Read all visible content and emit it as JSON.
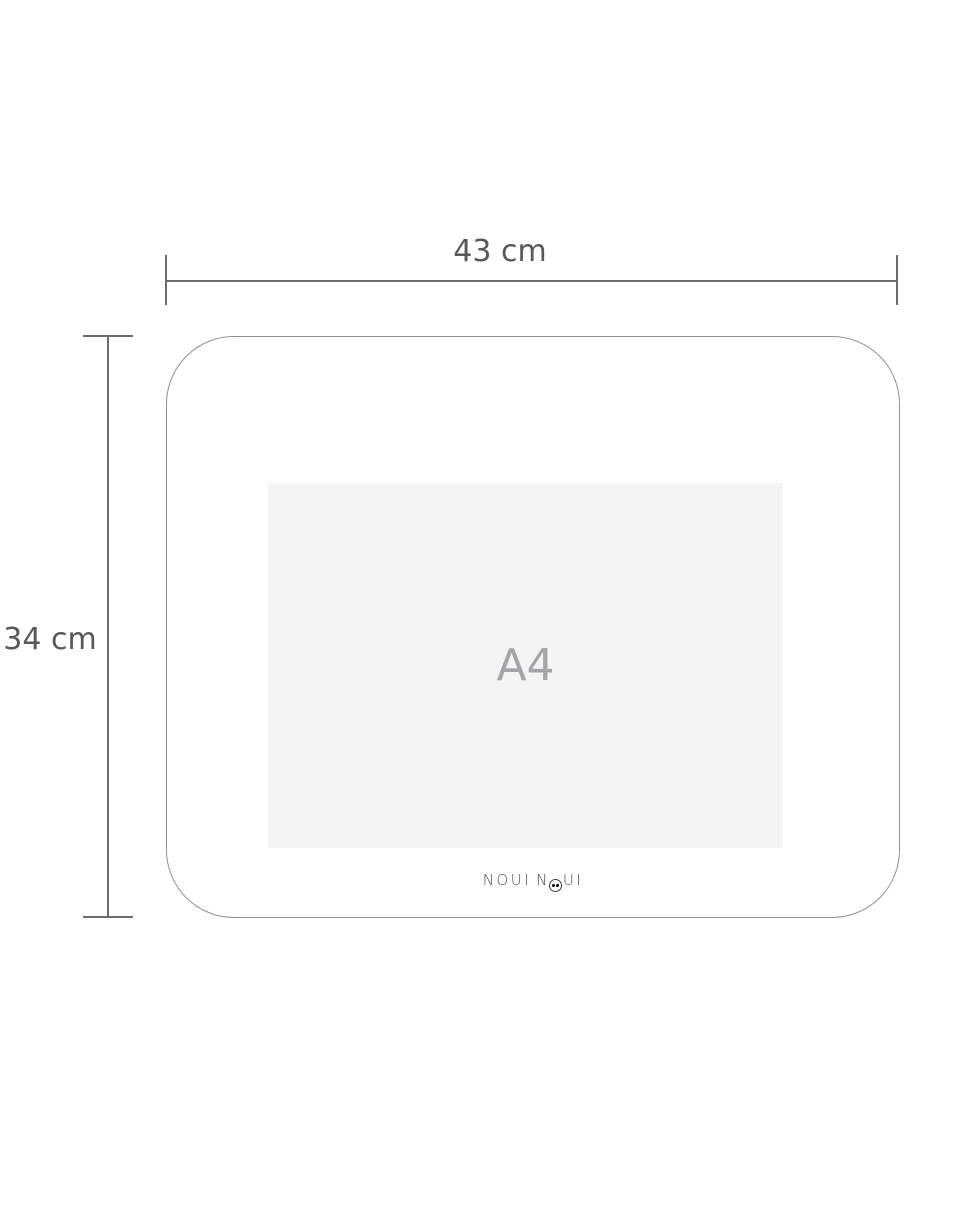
{
  "diagram": {
    "title": "placemat-dimension-diagram",
    "dimensions": {
      "width_label": "43 cm",
      "height_label": "34 cm",
      "width_cm": 43,
      "height_cm": 34
    },
    "inner_reference": {
      "label": "A4"
    },
    "brand": {
      "word1": "NOUI",
      "word2_start": "N",
      "word2_end": "UI",
      "full_text": "NOUI NOUI"
    },
    "colors": {
      "background": "#ffffff",
      "dimension_line": "#6a6b6d",
      "dimension_text": "#57585a",
      "placemat_outline": "#919294",
      "inner_fill": "#f4f4f5",
      "inner_text": "#a5a5a9",
      "brand_text": "#4d4d4f"
    }
  }
}
